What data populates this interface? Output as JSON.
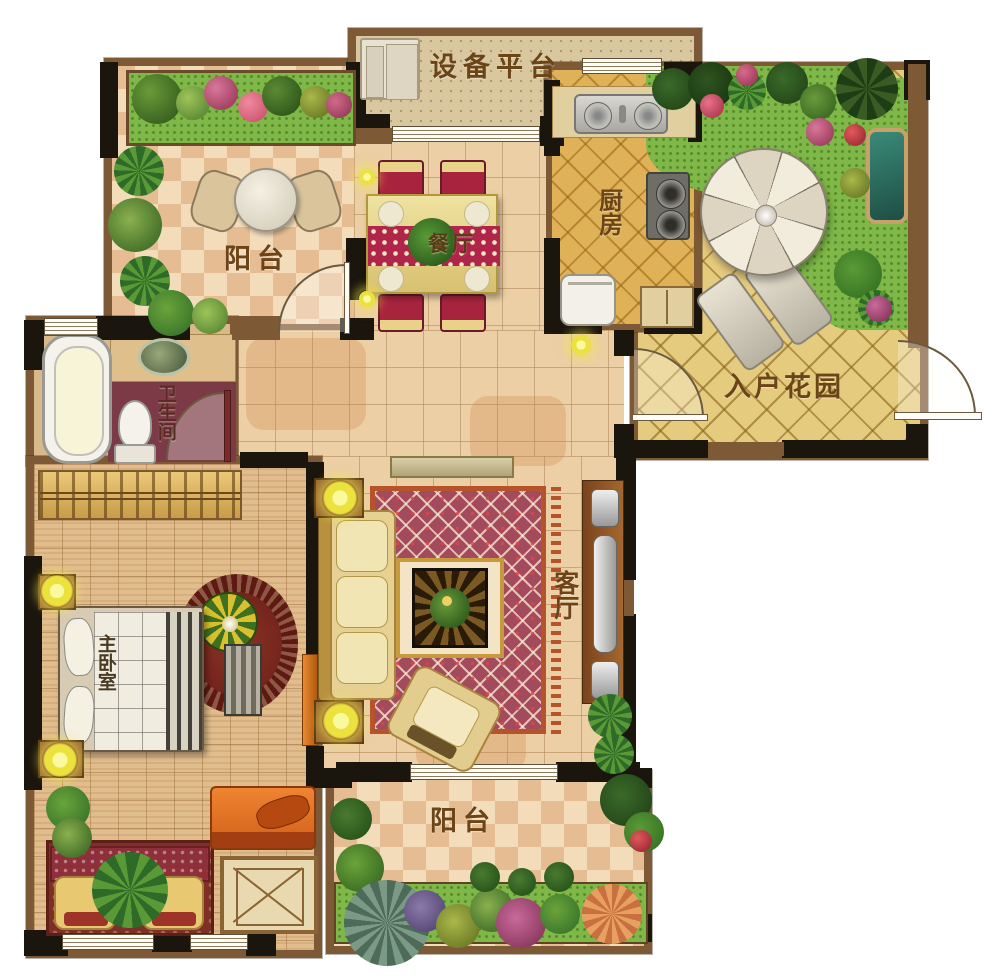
{
  "plan": {
    "rooms": {
      "balcony_top": {
        "label": "阳台"
      },
      "equipment_platform": {
        "label": "设备平台"
      },
      "kitchen": {
        "label": "厨房"
      },
      "entry_garden": {
        "label": "入户花园"
      },
      "dining": {
        "label": "餐厅"
      },
      "bathroom": {
        "label": "卫生间"
      },
      "living": {
        "label": "客厅"
      },
      "master_bedroom": {
        "label": "主卧室"
      },
      "balcony_bottom": {
        "label": "阳台"
      }
    },
    "palette": {
      "wall_black": "#1a150d",
      "wall_brown": "#7d5a35",
      "tile_light": "#f3dcba",
      "tile_dark": "#e6bd93",
      "kitchen_gold": "#dfb258",
      "patio_gold": "#e5cb7d",
      "grass_green": "#7fb848",
      "bath_floor_red": "#7c3a46",
      "carpet_red": "#a34a5c",
      "accent_orange": "#e07a2a",
      "lamp_yellow": "#ece23e",
      "pond_teal": "#2e6e62"
    }
  }
}
